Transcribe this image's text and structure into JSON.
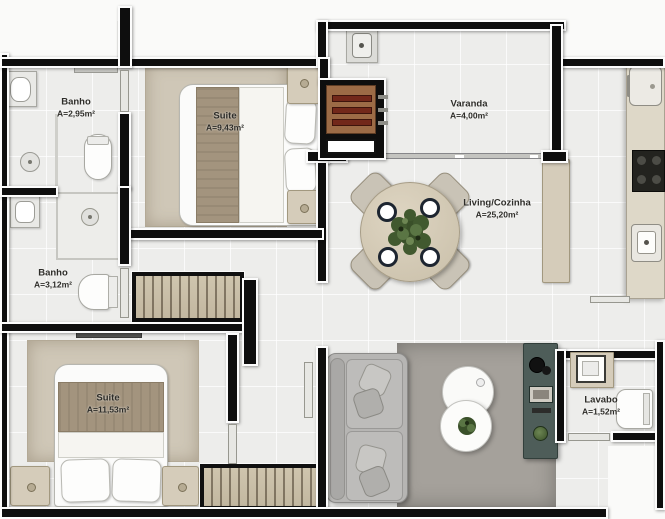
{
  "plan": {
    "rooms": [
      {
        "id": "banho-1",
        "name": "Banho",
        "area": "A=2,95m²"
      },
      {
        "id": "suite-1",
        "name": "Suite",
        "area": "A=9,43m²"
      },
      {
        "id": "varanda",
        "name": "Varanda",
        "area": "A=4,00m²"
      },
      {
        "id": "living-cozinha",
        "name": "Living/Cozinha",
        "area": "A=25,20m²"
      },
      {
        "id": "banho-2",
        "name": "Banho",
        "area": "A=3,12m²"
      },
      {
        "id": "suite-2",
        "name": "Suite",
        "area": "A=11,53m²"
      },
      {
        "id": "lavabo",
        "name": "Lavabo",
        "area": "A=1,52m²"
      }
    ],
    "colors": {
      "wall": "#0e0e0e",
      "wall-outline": "#fcfcfc",
      "floor": "#ededeb",
      "bedroom-rug": "#cfc7b7",
      "living-rug": "#a5a19b",
      "blanket": "#a3947e",
      "furniture-beige": "#d5ccba",
      "sofa": "#b6b5b3",
      "tv-rack": "#4e5d59",
      "kitchen-counter": "#ded8c8",
      "grill": "#9c6b46",
      "plant": "#41592f"
    },
    "furniture": [
      "double-bed",
      "nightstand",
      "wardrobe",
      "dining-table",
      "dining-chair",
      "dinner-plate",
      "centerpiece-plant",
      "sofa",
      "throw-pillow",
      "coffee-table",
      "tv-rack",
      "kitchen-counter",
      "fridge",
      "cooktop",
      "kitchen-sink",
      "island-counter",
      "barbecue-grill",
      "varanda-sink",
      "toilet",
      "bathroom-sink",
      "shower",
      "sliding-glass-door"
    ]
  }
}
